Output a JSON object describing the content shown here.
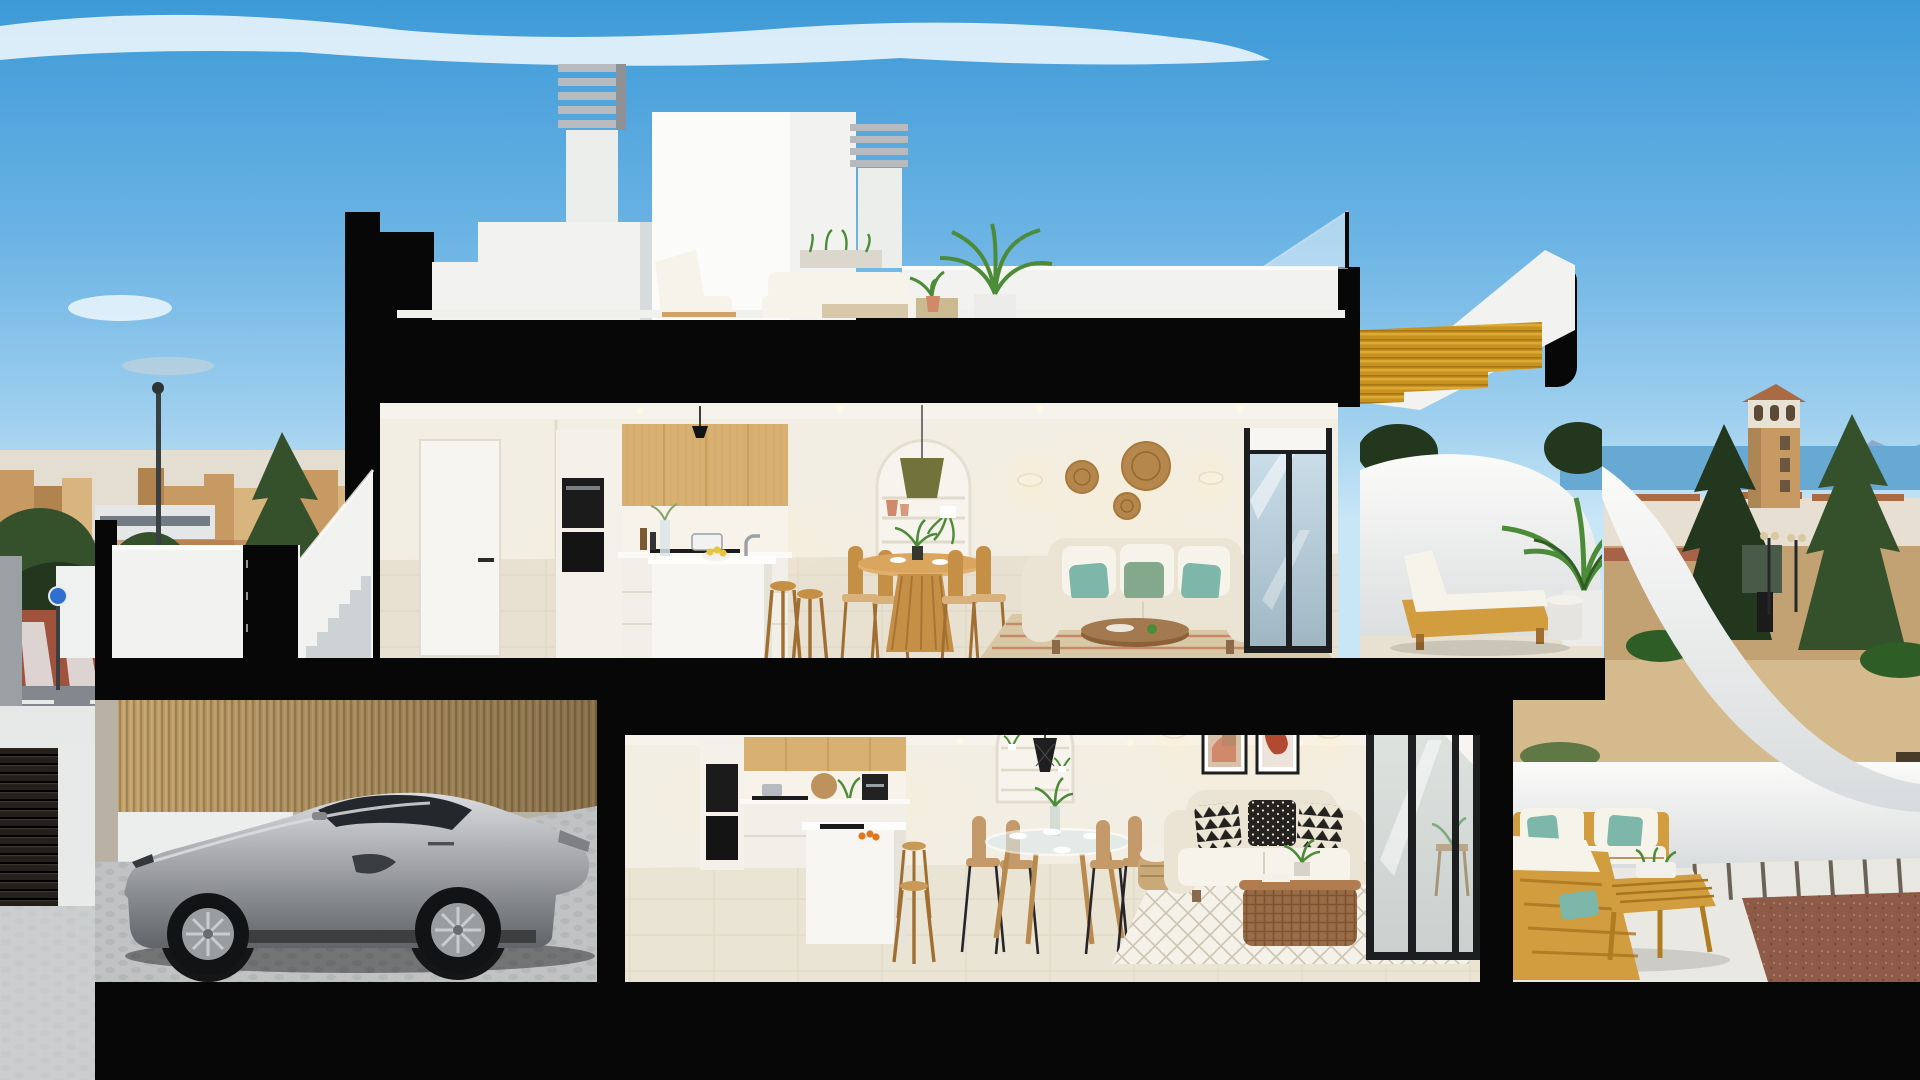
{
  "meta": {
    "title": "Cross-section render of a two-storey coastal villa",
    "type": "photorealistic architectural cutaway, no visible text"
  },
  "scene": {
    "sky": "clear blue sky with thin white cloud band at top",
    "background_left": "Mediterranean town skyline, pine trees, red paved street with crosswalk, blue traffic sign, street lamp",
    "background_right": "sea strip with distant mountains, tan watchtower with terracotta roof, dark pine trees, sandy lot with lamp posts",
    "roof_level": "roof terrace with white outdoor lounge set, two louvered chimneys, glass balustrade, potted palm",
    "upper_floor": [
      "entry door and hallway",
      "kitchen with oak upper cabinets, black ovens, white island, two stools",
      "round wooden dining table with four chairs",
      "arched shelf niche with olive pendant lamp and terracotta vases",
      "cream sofa with green and teal pillows",
      "rattan wall discs and sconces",
      "dark framed sliding glass door",
      "terrace with wooden lounger, side table and palm under golden wood stair soffit"
    ],
    "ground_floor": [
      "garage with silver sports coupe on cobbled floor and bamboo slat wall",
      "kitchen with oak uppers, black oven, coffee machine, island with orange fruit bowl, wooden stools",
      "round glass dining table with tan chairs",
      "arched niche with black wire pendant and plants",
      "beige sofa with black-and-white pillows, two abstract art frames, sconces",
      "rattan coffee table on white diamond rug",
      "sliding glass door",
      "terrace with teak sofa set, teal pillows, slat coffee table, paver strip and red gravel"
    ],
    "entry": "white parapet with black gate and concrete stairs rising to the upper floor"
  },
  "colors": {
    "sky_top": "#3d9ad7",
    "sky_mid": "#6ab3e4",
    "sky_low": "#9ecfee",
    "sky_horizon": "#c9e6f6",
    "cloud": "#f4fafd",
    "cut_black": "#070707",
    "wall_white": "#f2f2f0",
    "wall_bright": "#fbfbf9",
    "wall_shadow": "#d8dbdd",
    "wall_grey": "#e4e6e7",
    "interior_wall": "#f3eee3",
    "interior_shadow": "#e3dccc",
    "ceiling": "#f6f3ec",
    "wood_cabinet": "#d8b172",
    "wood_cabinet_dark": "#c39a55",
    "stair_wood": "#c9921f",
    "stair_wood_light": "#e3b13f",
    "bamboo": "#c2a069",
    "bamboo_dark": "#8d7040",
    "furn_wood": "#c68f46",
    "furn_wood_dark": "#a06e30",
    "outdoor_wood": "#d19d3e",
    "floor_tile": "#e8e1d2",
    "floor_grout": "#d5cbb8",
    "floor_tile_low": "#eae4d4",
    "garage_floor": "#c0c2c3",
    "cobble": "#a8abac",
    "car_silver": "#a3a5a8",
    "car_light": "#dcdde0",
    "car_dark": "#5f6266",
    "car_glass": "#24272b",
    "tire": "#121315",
    "sofa_cream": "#ebe4d4",
    "cushion_white": "#f6f3ea",
    "pillow_teal": "#7cb7a9",
    "pillow_green": "#83a88c",
    "rattan": "#b6874c",
    "terracotta": "#d08a6b",
    "plant": "#4c8c38",
    "plant_dark": "#2e5d26",
    "tree": "#35512c",
    "tree_dark": "#22371d",
    "town_a": "#c79a63",
    "town_b": "#b0834f",
    "town_c": "#d8b57e",
    "town_light": "#e3ddd2",
    "roof_tile": "#a96a44",
    "sea": "#67a9d3",
    "mountain": "#8ba4c5",
    "sand": "#c2a273",
    "sand_light": "#d4ba8c",
    "road_red": "#a0523c",
    "road_grey": "#83888e",
    "line_white": "#e8eaea",
    "rug_beige": "#d9c8a6",
    "rug_white": "#f4f1e9",
    "rug_line": "#c6bda9",
    "frame_dark": "#1d1e1f",
    "glass": "#cfe2ee",
    "glass_dark": "#9fb6c2",
    "lamp_olive": "#72733a",
    "art_red": "#b24931",
    "art_beige": "#d8c0ab",
    "gravel": "#8d5b47",
    "metal": "#b7bbc0",
    "glow": "#ffedc8"
  }
}
